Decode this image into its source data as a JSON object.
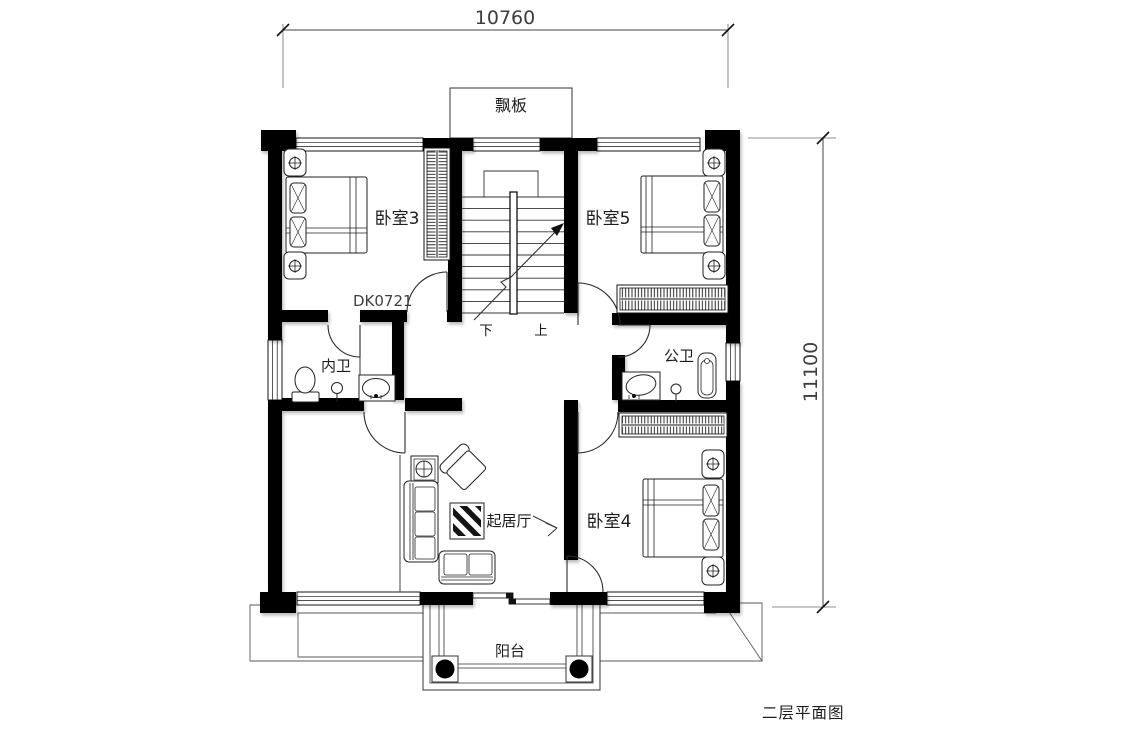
{
  "drawing": {
    "caption": "二层平面图",
    "canopy_label": "飘板",
    "balcony_label": "阳台",
    "door_code": "DK0721",
    "stairs": {
      "down": "下",
      "up": "上"
    },
    "dimensions": {
      "overall_width_mm": "10760",
      "overall_depth_mm": "11100"
    },
    "rooms": {
      "bedroom3": "卧室3",
      "bedroom5": "卧室5",
      "bedroom4": "卧室4",
      "bath_private": "内卫",
      "bath_public": "公卫",
      "living": "起居厅"
    },
    "colors": {
      "wall": "#000000",
      "line": "#2a2a2a",
      "dim": "#404040",
      "background": "#ffffff"
    }
  }
}
